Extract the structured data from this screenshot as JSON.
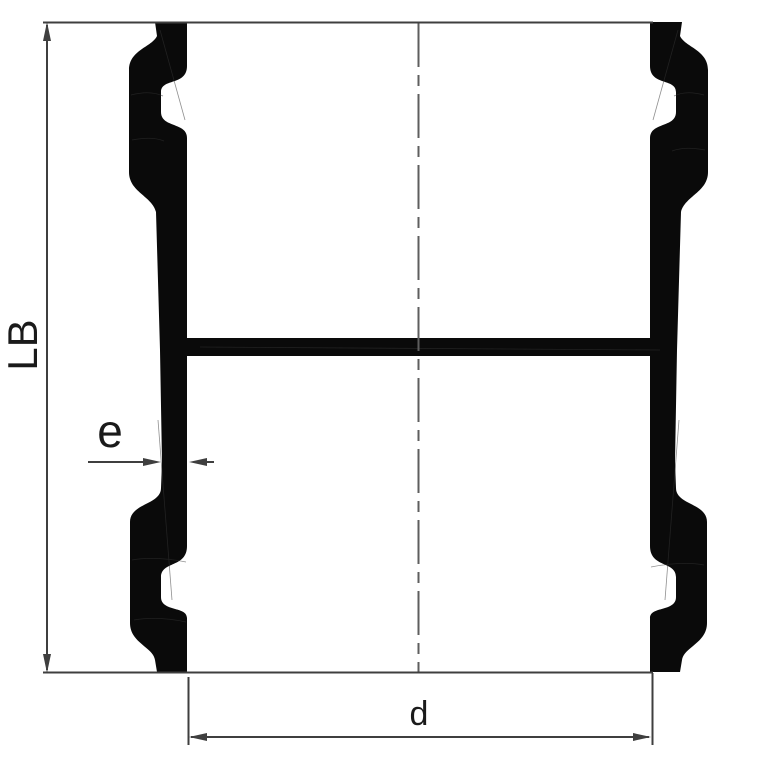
{
  "diagram": {
    "labels": {
      "length": "LB",
      "wall_thickness": "e",
      "diameter": "d"
    },
    "colors": {
      "background": "#ffffff",
      "profile_fill": "#0a0a0a",
      "dimension_line": "#3f3f3f",
      "centerline": "#5e5e5e",
      "label_color": "#1a1a1a"
    }
  }
}
